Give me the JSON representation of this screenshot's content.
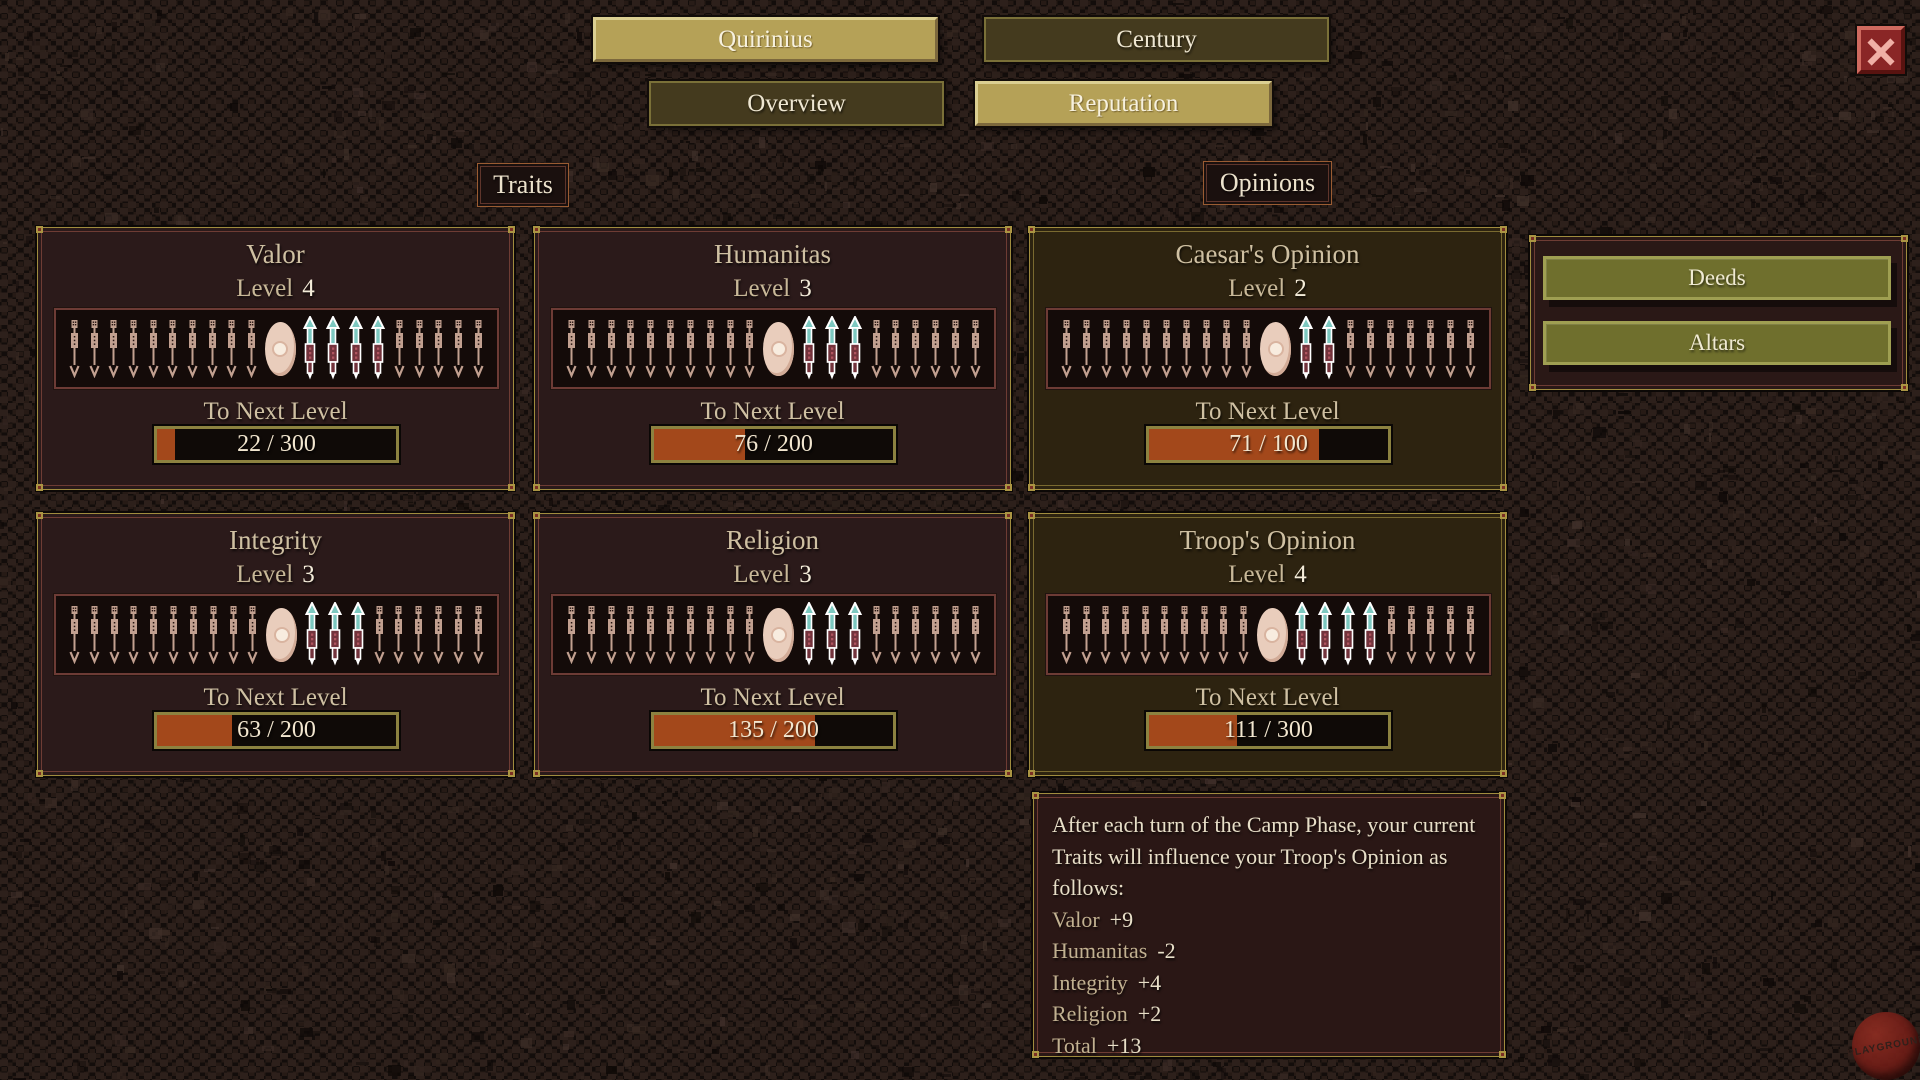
{
  "colors": {
    "tab_selected_bg": "#b5a157",
    "tab_unselected_bg": "#443a1e",
    "panel_trait_bg": "#2b1a1a",
    "panel_opinion_bg": "#2d2310",
    "progress_fill": "#a3481b",
    "gold_border": "#a08c3e",
    "olive_button_bg": "#6f6f2d",
    "close_button_bg": "#8a2626",
    "text_cream": "#efe6d0",
    "text_tan": "#cfc0a2"
  },
  "tabs": [
    {
      "label": "Quirinius",
      "selected": true
    },
    {
      "label": "Century",
      "selected": false
    },
    {
      "label": "Overview",
      "selected": false
    },
    {
      "label": "Reputation",
      "selected": true
    }
  ],
  "icons": {
    "close": "x-cross",
    "plain_marker": "dagger-icon",
    "highlight_marker": "dagger-icon-highlighted",
    "level_marker": "medallion-icon"
  },
  "sections": {
    "traits": "Traits",
    "opinions": "Opinions"
  },
  "slider": {
    "slots_left": 10,
    "slots_right": 9
  },
  "panels": [
    {
      "title": "Valor",
      "group": "trait",
      "level_label": "Level",
      "level": 4,
      "to_next_label": "To Next Level",
      "progress_current": 22,
      "progress_max": 300,
      "progress_text": "22 / 300"
    },
    {
      "title": "Humanitas",
      "group": "trait",
      "level_label": "Level",
      "level": 3,
      "to_next_label": "To Next Level",
      "progress_current": 76,
      "progress_max": 200,
      "progress_text": "76 / 200"
    },
    {
      "title": "Caesar's Opinion",
      "group": "opinion",
      "level_label": "Level",
      "level": 2,
      "to_next_label": "To Next Level",
      "progress_current": 71,
      "progress_max": 100,
      "progress_text": "71 / 100"
    },
    {
      "title": "Integrity",
      "group": "trait",
      "level_label": "Level",
      "level": 3,
      "to_next_label": "To Next Level",
      "progress_current": 63,
      "progress_max": 200,
      "progress_text": "63 / 200"
    },
    {
      "title": "Religion",
      "group": "trait",
      "level_label": "Level",
      "level": 3,
      "to_next_label": "To Next Level",
      "progress_current": 135,
      "progress_max": 200,
      "progress_text": "135 / 200"
    },
    {
      "title": "Troop's Opinion",
      "group": "opinion",
      "level_label": "Level",
      "level": 4,
      "to_next_label": "To Next Level",
      "progress_current": 111,
      "progress_max": 300,
      "progress_text": "111 / 300"
    }
  ],
  "side_buttons": [
    {
      "label": "Deeds"
    },
    {
      "label": "Altars"
    }
  ],
  "info_panel": {
    "intro_lines": [
      "After each turn of the Camp Phase, your current",
      "Traits will influence your Troop's Opinion as",
      "follows:"
    ],
    "modifiers": [
      {
        "label": "Valor",
        "value": "+9"
      },
      {
        "label": "Humanitas",
        "value": "-2"
      },
      {
        "label": "Integrity",
        "value": "+4"
      },
      {
        "label": "Religion",
        "value": "+2"
      },
      {
        "label": "Total",
        "value": "+13"
      }
    ]
  },
  "watermark": "PLAYGROUND"
}
